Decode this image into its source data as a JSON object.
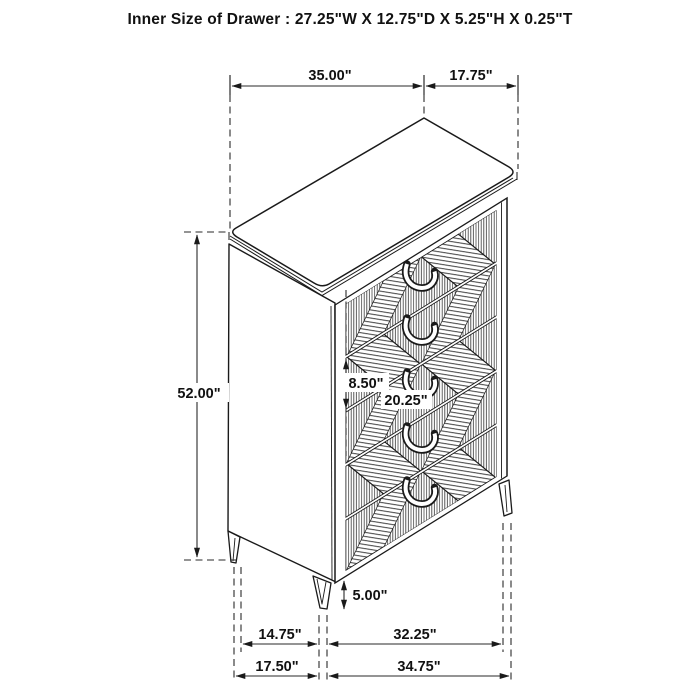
{
  "title": "Inner Size of Drawer : 27.25\"W X 12.75\"D X 5.25\"H X 0.25\"T",
  "figure": {
    "type": "furniture-dimension-diagram",
    "subject": "5-drawer chest, isometric line drawing with argyle-pattern drawer fronts",
    "drawer_count": 5
  },
  "dimensions": {
    "top_width": "35.00\"",
    "top_depth": "17.75\"",
    "overall_height": "52.00\"",
    "drawer_front_height": "8.50\"",
    "drawer_opening_width": "20.25\"",
    "leg_height": "5.00\"",
    "leg_span_depth": "14.75\"",
    "leg_span_width": "32.25\"",
    "base_total_depth": "17.50\"",
    "base_total_width": "34.75\""
  },
  "colors": {
    "background": "#ffffff",
    "line": "#1a1a1a",
    "hatch": "#3f3f3f"
  }
}
